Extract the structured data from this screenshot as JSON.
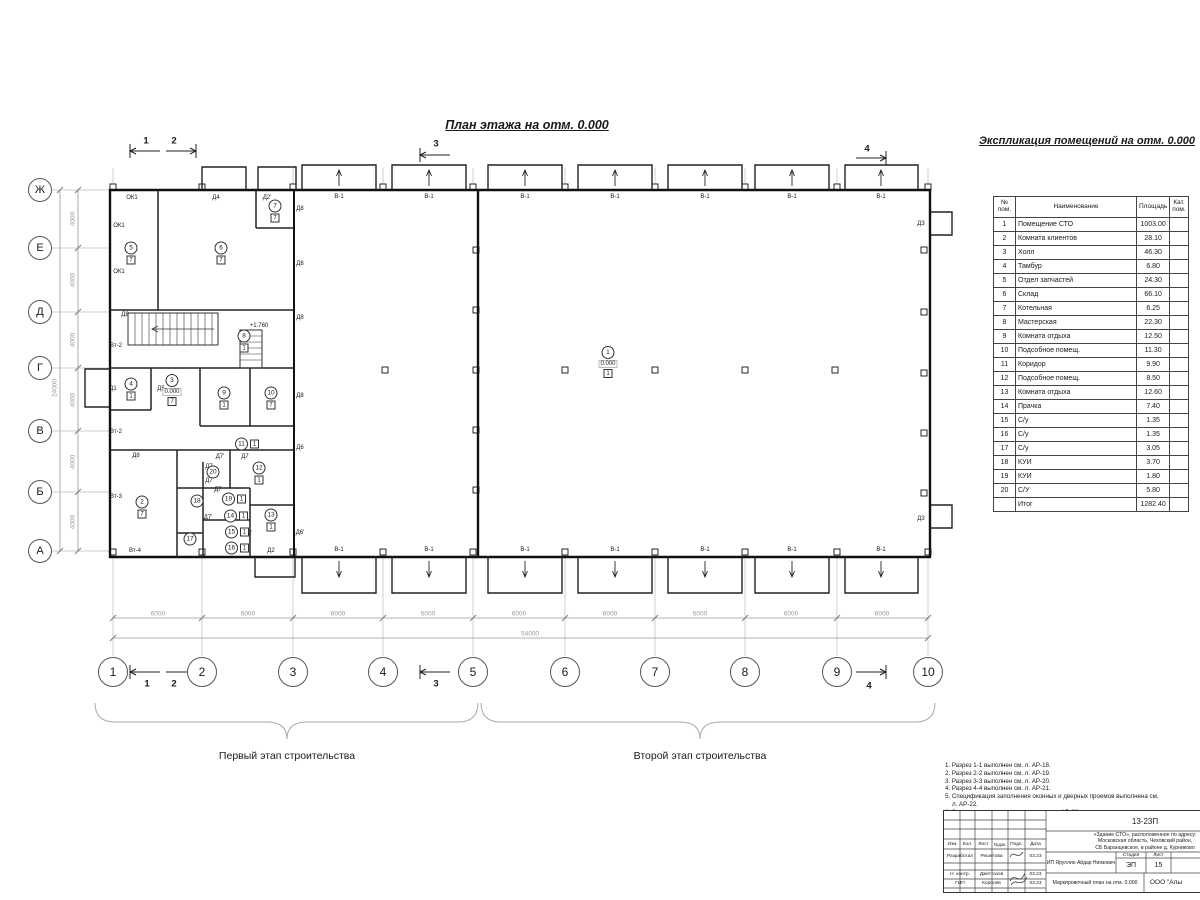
{
  "palette": {
    "line": "#1a1a1a",
    "dim": "#999999",
    "grid": "#bbbbbb"
  },
  "drawing": {
    "title": "План этажа на отм. 0.000",
    "stage1_label": "Первый этап строительства",
    "stage2_label": "Второй этап строительства"
  },
  "axes": {
    "left": [
      {
        "label": "Ж",
        "x": 40,
        "y": 190
      },
      {
        "label": "Е",
        "x": 40,
        "y": 248
      },
      {
        "label": "Д",
        "x": 40,
        "y": 312
      },
      {
        "label": "Г",
        "x": 40,
        "y": 368
      },
      {
        "label": "В",
        "x": 40,
        "y": 431
      },
      {
        "label": "Б",
        "x": 40,
        "y": 492
      },
      {
        "label": "А",
        "x": 40,
        "y": 551
      }
    ],
    "bottom": [
      {
        "label": "1",
        "x": 113,
        "y": 672
      },
      {
        "label": "2",
        "x": 202,
        "y": 672
      },
      {
        "label": "3",
        "x": 293,
        "y": 672
      },
      {
        "label": "4",
        "x": 383,
        "y": 672
      },
      {
        "label": "5",
        "x": 473,
        "y": 672
      },
      {
        "label": "6",
        "x": 565,
        "y": 672
      },
      {
        "label": "7",
        "x": 655,
        "y": 672
      },
      {
        "label": "8",
        "x": 745,
        "y": 672
      },
      {
        "label": "9",
        "x": 837,
        "y": 672
      },
      {
        "label": "10",
        "x": 928,
        "y": 672
      }
    ]
  },
  "dims": {
    "bottom_segments": [
      {
        "label": "6000",
        "x": 158,
        "y": 614
      },
      {
        "label": "6000",
        "x": 248,
        "y": 614
      },
      {
        "label": "6000",
        "x": 338,
        "y": 614
      },
      {
        "label": "6000",
        "x": 428,
        "y": 614
      },
      {
        "label": "6000",
        "x": 519,
        "y": 614
      },
      {
        "label": "6000",
        "x": 610,
        "y": 614
      },
      {
        "label": "6000",
        "x": 700,
        "y": 614
      },
      {
        "label": "6000",
        "x": 791,
        "y": 614
      },
      {
        "label": "6000",
        "x": 882,
        "y": 614
      }
    ],
    "bottom_total": {
      "label": "54000",
      "x": 530,
      "y": 634
    },
    "left_segments": [
      {
        "label": "4000",
        "x": 73,
        "y": 219
      },
      {
        "label": "4000",
        "x": 73,
        "y": 280
      },
      {
        "label": "4000",
        "x": 73,
        "y": 340
      },
      {
        "label": "4000",
        "x": 73,
        "y": 400
      },
      {
        "label": "4000",
        "x": 73,
        "y": 462
      },
      {
        "label": "4000",
        "x": 73,
        "y": 522
      }
    ],
    "left_total": {
      "label": "24000",
      "x": 55,
      "y": 388
    }
  },
  "section_markers": [
    {
      "label": "1",
      "x": 146,
      "y": 141
    },
    {
      "label": "2",
      "x": 174,
      "y": 141
    },
    {
      "label": "3",
      "x": 436,
      "y": 144
    },
    {
      "label": "4",
      "x": 867,
      "y": 149
    },
    {
      "label": "1",
      "x": 147,
      "y": 684
    },
    {
      "label": "2",
      "x": 174,
      "y": 684
    },
    {
      "label": "3",
      "x": 436,
      "y": 684
    },
    {
      "label": "4",
      "x": 869,
      "y": 686
    }
  ],
  "rooms": [
    {
      "num": "1",
      "x": 608,
      "y": 362,
      "floor": "1",
      "elev": "0.000"
    },
    {
      "num": "2",
      "x": 142,
      "y": 507,
      "floor": "7"
    },
    {
      "num": "3",
      "x": 172,
      "y": 390,
      "floor": "7",
      "elev": "0.000"
    },
    {
      "num": "4",
      "x": 131,
      "y": 389,
      "floor": "1"
    },
    {
      "num": "5",
      "x": 131,
      "y": 253,
      "floor": "7"
    },
    {
      "num": "6",
      "x": 221,
      "y": 253,
      "floor": "7"
    },
    {
      "num": "7",
      "x": 275,
      "y": 211,
      "floor": "7"
    },
    {
      "num": "8",
      "x": 244,
      "y": 341,
      "floor": "1"
    },
    {
      "num": "9",
      "x": 224,
      "y": 398,
      "floor": "1"
    },
    {
      "num": "10",
      "x": 271,
      "y": 398,
      "floor": "7"
    },
    {
      "num": "11",
      "x": 247,
      "y": 444,
      "floor": "1",
      "side": "r"
    },
    {
      "num": "12",
      "x": 259,
      "y": 473,
      "floor": "1"
    },
    {
      "num": "13",
      "x": 271,
      "y": 520,
      "floor": "1"
    },
    {
      "num": "14",
      "x": 236,
      "y": 516,
      "floor": "1",
      "side": "r"
    },
    {
      "num": "15",
      "x": 237,
      "y": 532,
      "floor": "1",
      "side": "r"
    },
    {
      "num": "16",
      "x": 237,
      "y": 548,
      "floor": "1",
      "side": "r"
    },
    {
      "num": "17",
      "x": 190,
      "y": 539
    },
    {
      "num": "18",
      "x": 197,
      "y": 501
    },
    {
      "num": "19",
      "x": 234,
      "y": 499,
      "floor": "1",
      "side": "r"
    },
    {
      "num": "20",
      "x": 213,
      "y": 472
    }
  ],
  "plan_labels": [
    {
      "t": "ОК1",
      "x": 132,
      "y": 198
    },
    {
      "t": "ОК1",
      "x": 119,
      "y": 226
    },
    {
      "t": "ОК1",
      "x": 119,
      "y": 272
    },
    {
      "t": "Д8",
      "x": 125,
      "y": 315
    },
    {
      "t": "Вт-2",
      "x": 116,
      "y": 346
    },
    {
      "t": "Д1",
      "x": 113,
      "y": 389
    },
    {
      "t": "Д5",
      "x": 161,
      "y": 389
    },
    {
      "t": "Вт-2",
      "x": 116,
      "y": 432
    },
    {
      "t": "Д8",
      "x": 136,
      "y": 456
    },
    {
      "t": "Вт-3",
      "x": 116,
      "y": 497
    },
    {
      "t": "Вт-4",
      "x": 135,
      "y": 551
    },
    {
      "t": "Д4",
      "x": 216,
      "y": 198
    },
    {
      "t": "Д2'",
      "x": 267,
      "y": 198
    },
    {
      "t": "Д8",
      "x": 300,
      "y": 209
    },
    {
      "t": "Д8",
      "x": 300,
      "y": 264
    },
    {
      "t": "Д8",
      "x": 300,
      "y": 318
    },
    {
      "t": "Д8",
      "x": 300,
      "y": 396
    },
    {
      "t": "Д6",
      "x": 300,
      "y": 448
    },
    {
      "t": "Д6'",
      "x": 300,
      "y": 533
    },
    {
      "t": "Д7'",
      "x": 220,
      "y": 457
    },
    {
      "t": "Д7",
      "x": 245,
      "y": 457
    },
    {
      "t": "Д7",
      "x": 209,
      "y": 467
    },
    {
      "t": "Д7",
      "x": 209,
      "y": 481
    },
    {
      "t": "Д7",
      "x": 218,
      "y": 490
    },
    {
      "t": "Д7'",
      "x": 208,
      "y": 518
    },
    {
      "t": "Д7",
      "x": 230,
      "y": 534
    },
    {
      "t": "Д7",
      "x": 230,
      "y": 549
    },
    {
      "t": "Д7'",
      "x": 248,
      "y": 534
    },
    {
      "t": "Д2",
      "x": 271,
      "y": 551
    },
    {
      "t": "Д3",
      "x": 921,
      "y": 224
    },
    {
      "t": "Д3",
      "x": 921,
      "y": 519
    },
    {
      "t": "+1.760",
      "x": 259,
      "y": 326
    },
    {
      "t": "В-1",
      "x": 339,
      "y": 197
    },
    {
      "t": "В-1",
      "x": 429,
      "y": 197
    },
    {
      "t": "В-1",
      "x": 525,
      "y": 197
    },
    {
      "t": "В-1",
      "x": 615,
      "y": 197
    },
    {
      "t": "В-1",
      "x": 705,
      "y": 197
    },
    {
      "t": "В-1",
      "x": 792,
      "y": 197
    },
    {
      "t": "В-1",
      "x": 881,
      "y": 197
    },
    {
      "t": "В-1",
      "x": 339,
      "y": 550
    },
    {
      "t": "В-1",
      "x": 429,
      "y": 550
    },
    {
      "t": "В-1",
      "x": 525,
      "y": 550
    },
    {
      "t": "В-1",
      "x": 615,
      "y": 550
    },
    {
      "t": "В-1",
      "x": 705,
      "y": 550
    },
    {
      "t": "В-1",
      "x": 792,
      "y": 550
    },
    {
      "t": "В-1",
      "x": 881,
      "y": 550
    }
  ],
  "expl_table": {
    "title": "Экспликация помещений на отм. 0.000",
    "headers": [
      "№ пом.",
      "Наименование",
      "Площадь",
      "Кат.\nпом."
    ],
    "rows": [
      [
        "1",
        "Помещение СТО",
        "1003.00",
        ""
      ],
      [
        "2",
        "Комната клиентов",
        "28.10",
        ""
      ],
      [
        "3",
        "Холл",
        "46.30",
        ""
      ],
      [
        "4",
        "Тамбур",
        "6.80",
        ""
      ],
      [
        "5",
        "Отдел запчастей",
        "24.30",
        ""
      ],
      [
        "6",
        "Склад",
        "66.10",
        ""
      ],
      [
        "7",
        "Котельная",
        "6.25",
        ""
      ],
      [
        "8",
        "Мастерская",
        "22.30",
        ""
      ],
      [
        "9",
        "Комната отдыха",
        "12.50",
        ""
      ],
      [
        "10",
        "Подсобное помещ.",
        "11.30",
        ""
      ],
      [
        "11",
        "Коридор",
        "9.90",
        ""
      ],
      [
        "12",
        "Подсобное помещ.",
        "8.50",
        ""
      ],
      [
        "13",
        "Комната отдыха",
        "12.60",
        ""
      ],
      [
        "14",
        "Прачка",
        "7.40",
        ""
      ],
      [
        "15",
        "С/у",
        "1.35",
        ""
      ],
      [
        "16",
        "С/у",
        "1.35",
        ""
      ],
      [
        "17",
        "С/у",
        "3.05",
        ""
      ],
      [
        "18",
        "КУИ",
        "3.70",
        ""
      ],
      [
        "19",
        "КУИ",
        "1.80",
        ""
      ],
      [
        "20",
        "С/У",
        "5.80",
        ""
      ]
    ],
    "total_label": "Итог",
    "total_value": "1282.40"
  },
  "notes": [
    "1. Разрез 1-1 выполнен см. л. АР-18.",
    "2. Разрез 2-2 выполнен см. л. АР-19.",
    "3. Разрез 3-3 выполнен см. л. АР-20.",
    "4. Разрез 4-4 выполнен см. л. АР-21.",
    "5. Спецификация заполнения оконных и дверных проемов выполнена см. л. АР-22.",
    "6. Экспликация полов выполнена см. л. АР-22."
  ],
  "title_block": {
    "doc_number": "13-23П",
    "project": "«Здание СТО», расположенное по адресу:\nМосковская область, Чеховский район,\nСБ Баранцевское, в районе д. Курниково",
    "cols": [
      "Изм",
      "Кол.",
      "Лист",
      "№док.",
      "Подп.",
      "Дата"
    ],
    "rows": [
      {
        "role": "Разработал",
        "name": "Решетова",
        "date": "03.23"
      },
      {
        "role": "Н. контр.",
        "name": "Джеттазов",
        "date": "03.23"
      },
      {
        "role": "ГИП",
        "name": "Королев",
        "date": "03.23"
      }
    ],
    "client": "ИП Яруллин Айдар Ниязович",
    "stage_label": "Стадия",
    "sheet_label": "Лист",
    "stage": "ЭП",
    "sheet": "15",
    "sheet_title": "Маркировочный план на отм. 0.000",
    "org": "ООО \"Алы"
  }
}
